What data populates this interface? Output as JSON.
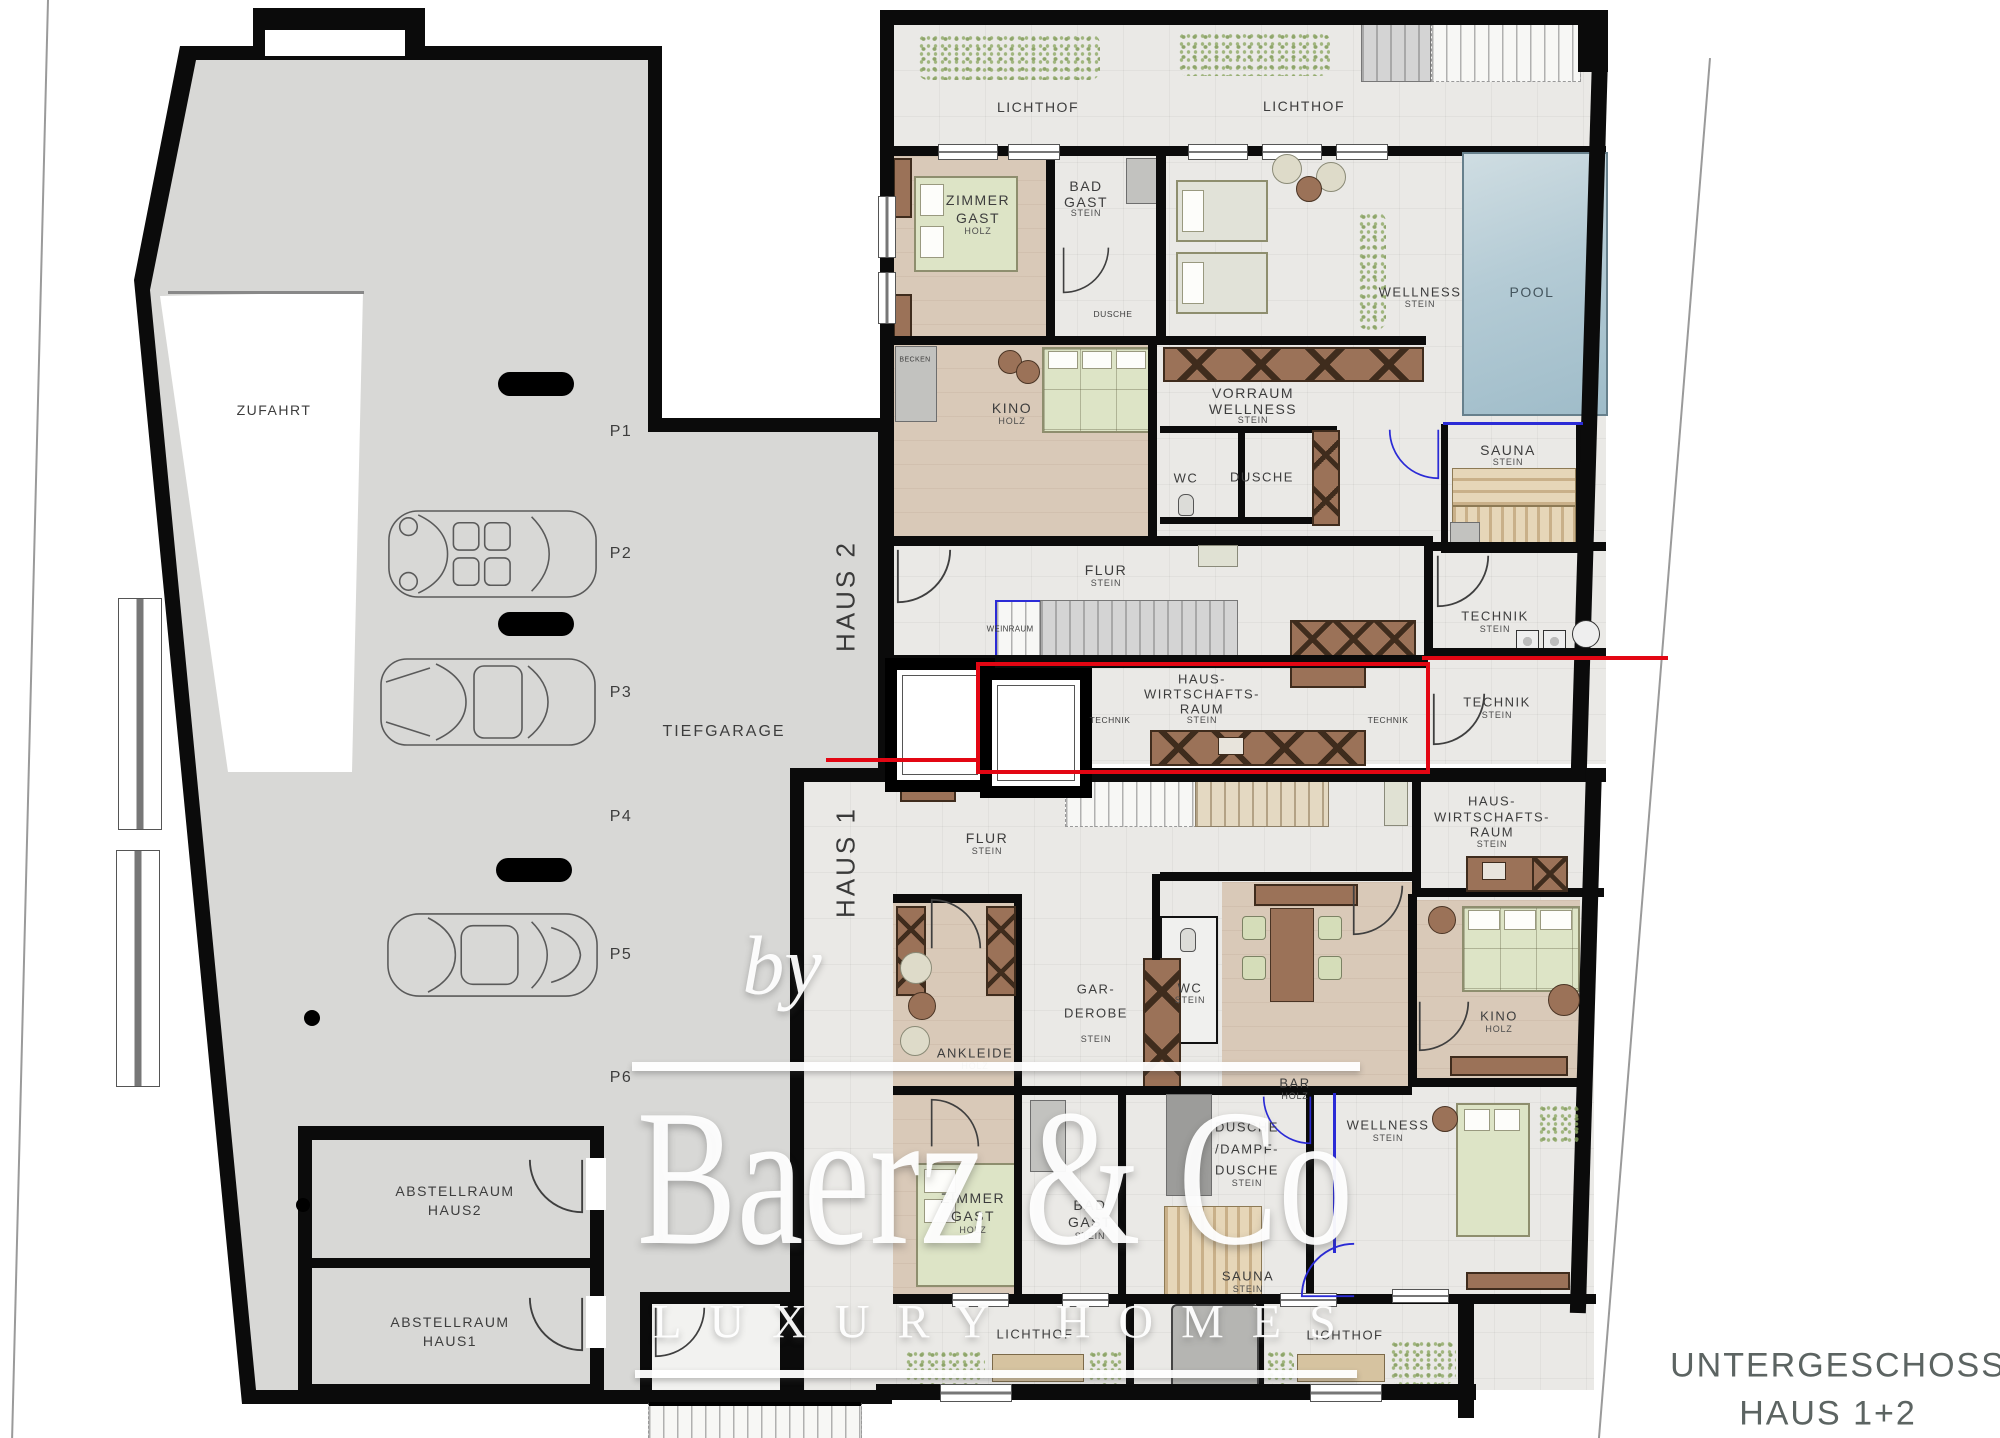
{
  "meta": {
    "sheet_title_line1": "UNTERGESCHOSS",
    "sheet_title_line2": "HAUS 1+2"
  },
  "watermark": {
    "by": "by",
    "brand": "Baerz & Co",
    "tagline": "LUXURY HOMES"
  },
  "garage": {
    "tiefgarage": "TIEFGARAGE",
    "zufahrt": "ZUFAHRT",
    "p1": "P1",
    "p2": "P2",
    "p3": "P3",
    "p4": "P4",
    "p5": "P5",
    "p6": "P6",
    "abstellraum2_l1": "ABSTELLRAUM",
    "abstellraum2_l2": "HAUS2",
    "abstellraum1_l1": "ABSTELLRAUM",
    "abstellraum1_l2": "HAUS1",
    "haus2": "HAUS 2",
    "haus1": "HAUS 1"
  },
  "haus2": {
    "lichthof_a": "LICHTHOF",
    "lichthof_b": "LICHTHOF",
    "zimmer_gast_l1": "ZIMMER",
    "zimmer_gast_l2": "GAST",
    "zimmer_gast_mat": "HOLZ",
    "bad_gast_l1": "BAD",
    "bad_gast_l2": "GAST",
    "bad_gast_mat": "STEIN",
    "dusche_klein": "DUSCHE",
    "becken": "BECKEN",
    "kino": "KINO",
    "kino_mat": "HOLZ",
    "wellness": "WELLNESS",
    "wellness_mat": "STEIN",
    "pool": "POOL",
    "vorraum_l1": "VORRAUM",
    "vorraum_l2": "WELLNESS",
    "vorraum_mat": "STEIN",
    "wc": "WC",
    "dusche": "DUSCHE",
    "sauna": "SAUNA",
    "sauna_mat": "STEIN",
    "flur": "FLUR",
    "flur_mat": "STEIN",
    "technik": "TECHNIK",
    "technik_mat": "STEIN",
    "weinraum": "WEINRAUM",
    "hwr_l1": "HAUS-",
    "hwr_l2": "WIRTSCHAFTS-",
    "hwr_l3": "RAUM",
    "hwr_mat": "STEIN",
    "technik_klein_links": "TECHNIK",
    "technik_klein_rechts": "TECHNIK"
  },
  "haus1": {
    "technik": "TECHNIK",
    "technik_mat": "STEIN",
    "flur": "FLUR",
    "flur_mat": "STEIN",
    "hwr_l1": "HAUS-",
    "hwr_l2": "WIRTSCHAFTS-",
    "hwr_l3": "RAUM",
    "hwr_mat": "STEIN",
    "ankleide": "ANKLEIDE",
    "ankleide_mat": "HOLZ",
    "garderobe_l1": "GAR-",
    "garderobe_l2": "DEROBE",
    "garderobe_mat": "STEIN",
    "wc": "WC",
    "wc_mat": "STEIN",
    "bar": "BAR",
    "bar_mat": "HOLZ",
    "kino": "KINO",
    "kino_mat": "HOLZ",
    "zimmer_gast_l1": "ZIMMER",
    "zimmer_gast_l2": "GAST",
    "zimmer_gast_mat": "HOLZ",
    "bad_gast_l1": "BAD",
    "bad_gast_l2": "GAST",
    "bad_gast_mat": "STEIN",
    "dusche_l1": "DUSCHE",
    "dusche_l2": "/DAMPF-",
    "dusche_l3": "DUSCHE",
    "dusche_mat": "STEIN",
    "sauna": "SAUNA",
    "sauna_mat": "STEIN",
    "wellness": "WELLNESS",
    "wellness_mat": "STEIN",
    "lichthof_a": "LICHTHOF",
    "lichthof_b": "LICHTHOF"
  },
  "colors": {
    "wall": "#0b0b0b",
    "garage_floor": "#d8d8d6",
    "stone_floor": "#eae9e6",
    "wood_floor": "#d9c9b8",
    "furniture_brown": "#9b7258",
    "bed_green": "#dde4c6",
    "pool_blue": "#aec6d2",
    "sauna_wood": "#e6d6b8",
    "annotation_red": "#e30613",
    "annotation_blue": "#2b2bd6",
    "title_gray": "#5c6462"
  }
}
